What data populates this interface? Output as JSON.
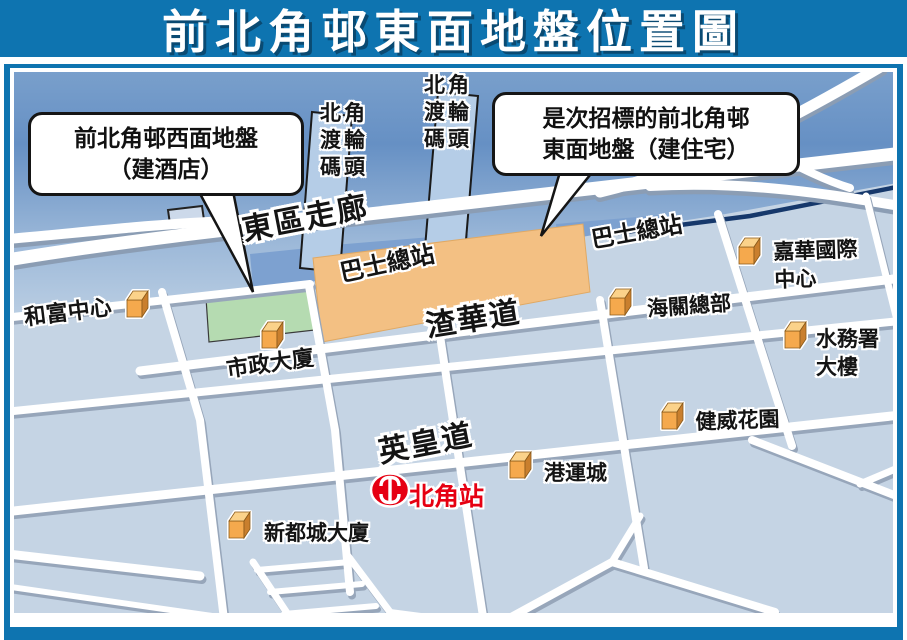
{
  "title": "前北角邨東面地盤位置圖",
  "callout_west": {
    "line1": "前北角邨西面地盤",
    "line2": "（建酒店）"
  },
  "callout_east": {
    "line1": "是次招標的前北角邨",
    "line2": "東面地盤（建住宅）"
  },
  "roads": {
    "eastern_corridor": "東區走廊",
    "java_road": "渣華道",
    "kings_road": "英皇道"
  },
  "pier_label": {
    "line1": "北角",
    "line2": "渡輪",
    "line3": "碼頭"
  },
  "bus_terminus_site": "巴士總站",
  "bus_terminus_right": "巴士總站",
  "places": {
    "wofoo": "和富中心",
    "municipal": "市政大廈",
    "customs": "海關總部",
    "kwah_line1": "嘉華國際",
    "kwah_line2": "中心",
    "wsd_line1": "水務署",
    "wsd_line2": "大樓",
    "healthy": "健威花園",
    "island_place": "港運城",
    "metropole": "新都城大廈"
  },
  "station": {
    "name": "北角站",
    "color": "#e60012"
  },
  "colors": {
    "frame_blue": "#0e74b0",
    "sea_top": "#6690c4",
    "sea_bottom": "#c4d5e6",
    "land": "#c5d4e4",
    "site_east_orange": "#f3c083",
    "site_west_green": "#b5dbb1",
    "building_orange": "#f5a94d",
    "road_white": "#ffffff",
    "station_red": "#e60012"
  }
}
